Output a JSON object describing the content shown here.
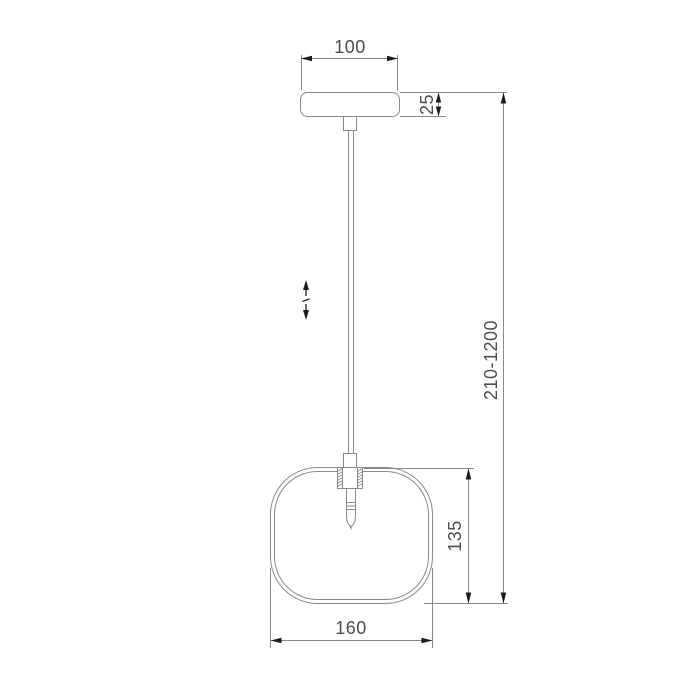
{
  "drawing": {
    "kind": "pendant-lamp-dimensional-drawing",
    "dimensions": {
      "canopy_width": "100",
      "canopy_height": "25",
      "hanging_height_range": "210-1200",
      "shade_height": "135",
      "shade_width": "160"
    },
    "icons": {
      "height_adjustable": "↕"
    }
  },
  "colors": {
    "background": "#ffffff",
    "line": "#8a8a8a",
    "text": "#4d4d4d",
    "arrow": "#1c1c1c"
  }
}
